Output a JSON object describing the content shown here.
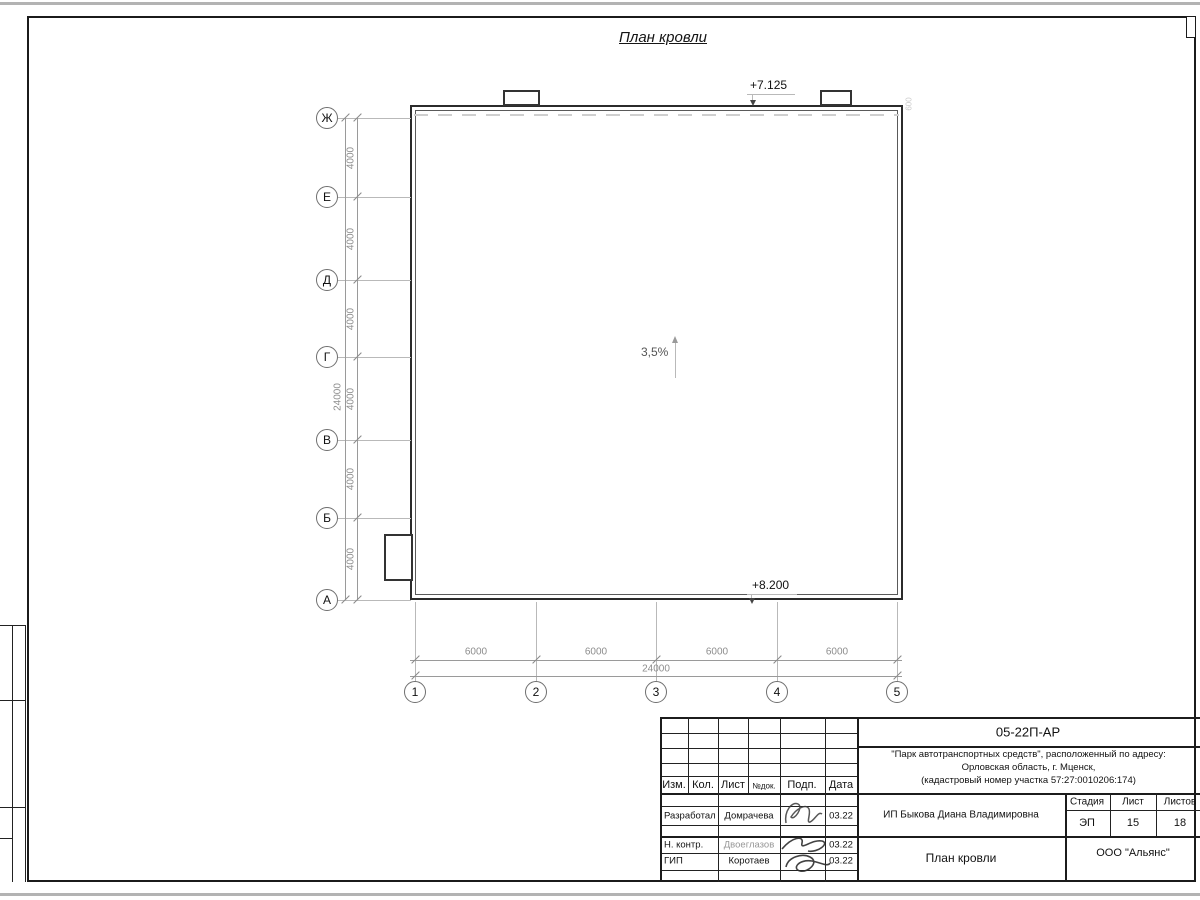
{
  "page": {
    "drawing_title": "План кровли"
  },
  "annotations": {
    "slope": "3,5%",
    "elev_top": "+7.125",
    "elev_bottom": "+8.200"
  },
  "axes": {
    "horizontal": [
      "Ж",
      "Е",
      "Д",
      "Г",
      "В",
      "Б",
      "А"
    ],
    "vertical": [
      "1",
      "2",
      "3",
      "4",
      "5"
    ]
  },
  "dims": {
    "left": [
      "4000",
      "4000",
      "4000",
      "4000",
      "4000",
      "4000"
    ],
    "left_total": "24000",
    "bottom": [
      "6000",
      "6000",
      "6000",
      "6000"
    ],
    "bottom_total": "24000",
    "parapet": "600"
  },
  "title_block": {
    "doc_number": "05-22П-АР",
    "project_line1": "\"Парк автотранспортных средств\",  расположенный по адресу:",
    "project_line2": "Орловская область, г. Мценск,",
    "project_line3": "(кадастровый номер участка 57:27:0010206:174)",
    "client": "ИП Быкова Диана Владимировна",
    "sheet_title": "План кровли",
    "company": "ООО \"Альянс\"",
    "stage_label": "Стадия",
    "sheet_label": "Лист",
    "sheets_label": "Листов",
    "stage": "ЭП",
    "sheet": "15",
    "sheets": "18",
    "header_cols": [
      "Изм.",
      "Кол.",
      "Лист",
      "№док.",
      "Подп.",
      "Дата"
    ],
    "rows": [
      {
        "role": "Разработал",
        "name": "Домрачева",
        "date": "03.22"
      },
      {
        "role": "Н. контр.",
        "name": "Двоеглазов",
        "date": "03.22"
      },
      {
        "role": "ГИП",
        "name": "Коротаев",
        "date": "03.22"
      }
    ]
  }
}
